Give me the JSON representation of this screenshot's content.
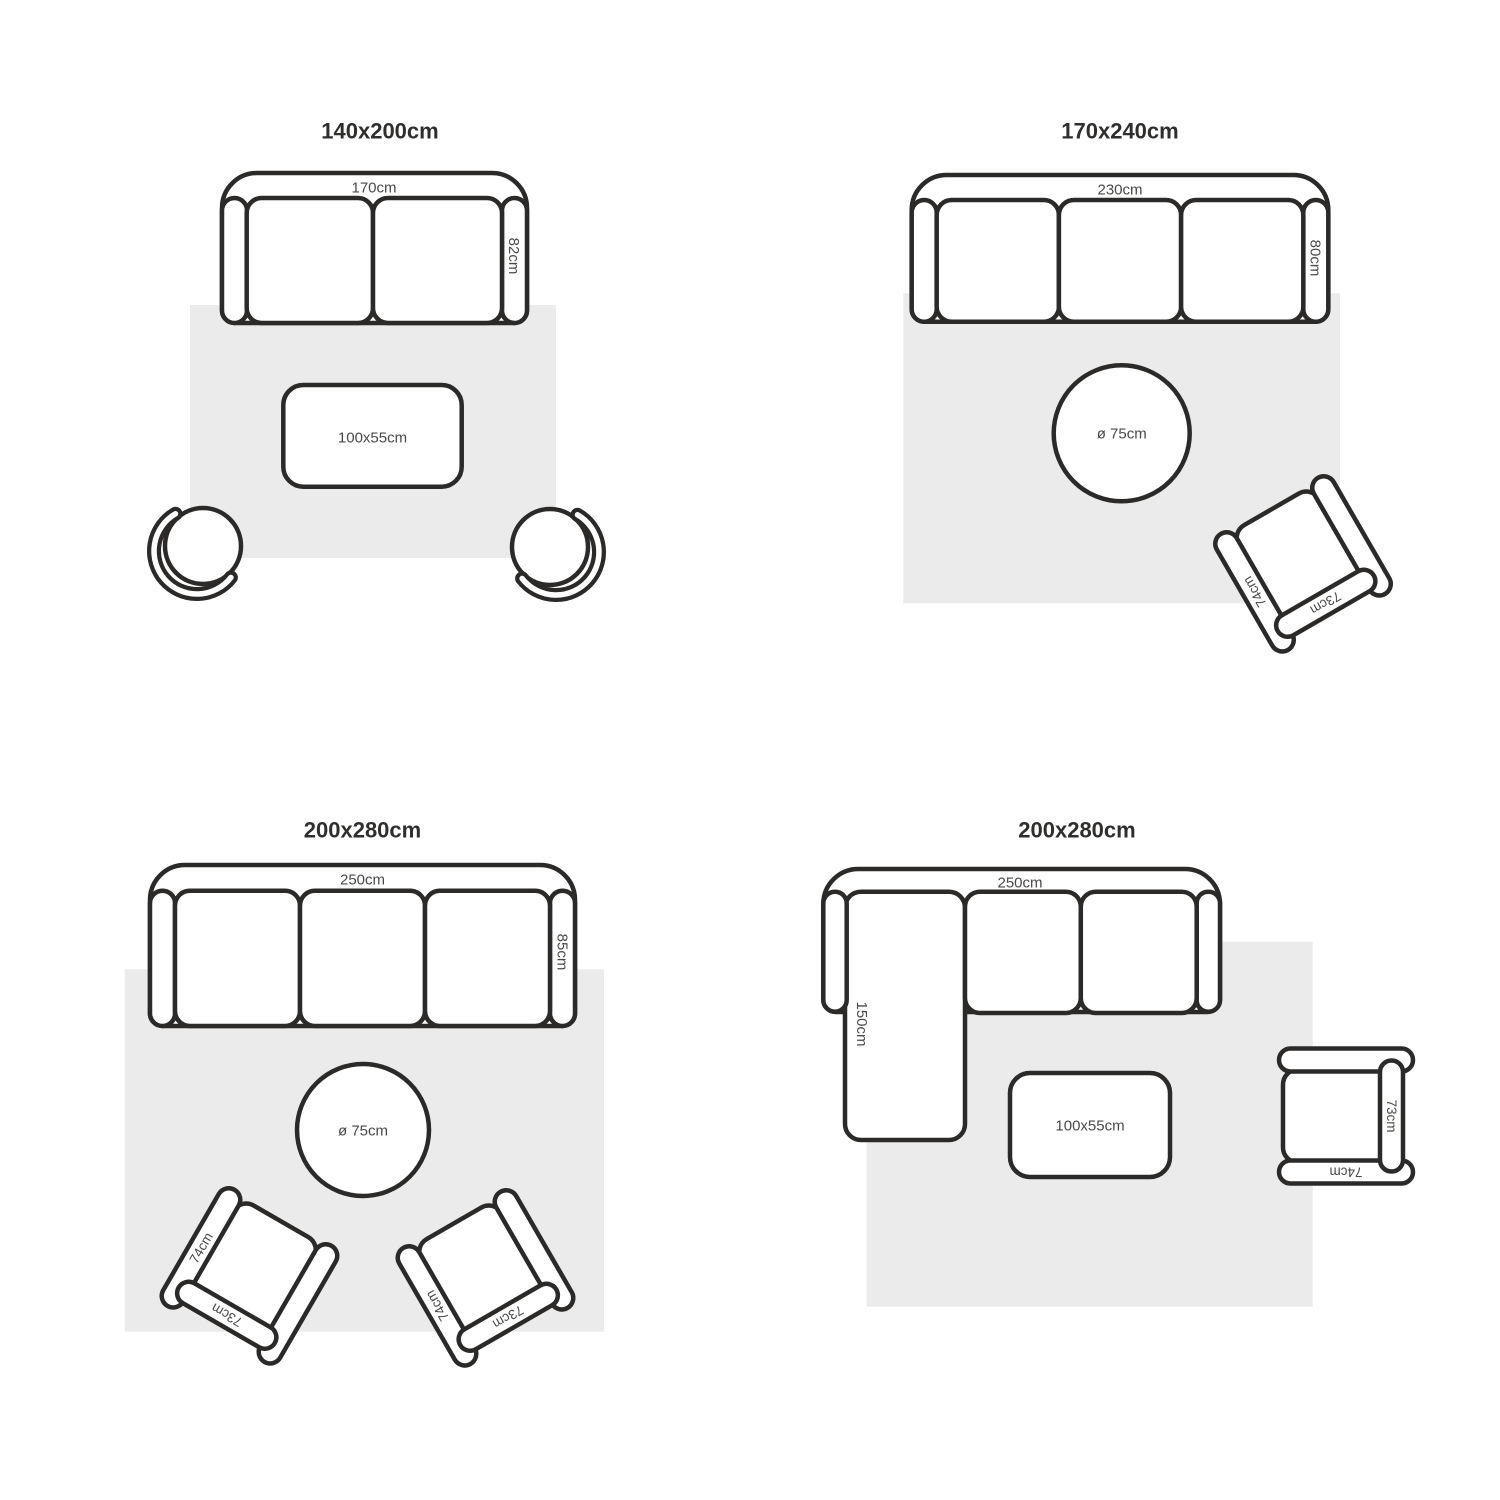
{
  "diagram": {
    "layouts": [
      {
        "title": "140x200cm",
        "sofa": {
          "width": "170cm",
          "depth": "82cm"
        },
        "coffee_table": {
          "size": "100x55cm"
        }
      },
      {
        "title": "170x240cm",
        "sofa": {
          "width": "230cm",
          "depth": "80cm"
        },
        "round_table": {
          "size": "ø 75cm"
        },
        "armchair": {
          "side": "74cm",
          "back": "73cm"
        }
      },
      {
        "title": "200x280cm",
        "sofa": {
          "width": "250cm",
          "depth": "85cm"
        },
        "round_table": {
          "size": "ø 75cm"
        },
        "armchair_left": {
          "side": "74cm",
          "back": "73cm"
        },
        "armchair_right": {
          "side": "74cm",
          "back": "73cm"
        }
      },
      {
        "title": "200x280cm",
        "sofa": {
          "width": "250cm",
          "chaise_depth": "150cm"
        },
        "coffee_table": {
          "size": "100x55cm"
        },
        "armchair": {
          "side": "74cm",
          "back": "73cm"
        }
      }
    ],
    "colors": {
      "line": "#2b2a29",
      "rug": "#ebebeb",
      "label": "#4a4948",
      "title": "#2f2e2d",
      "background": "#ffffff"
    }
  }
}
